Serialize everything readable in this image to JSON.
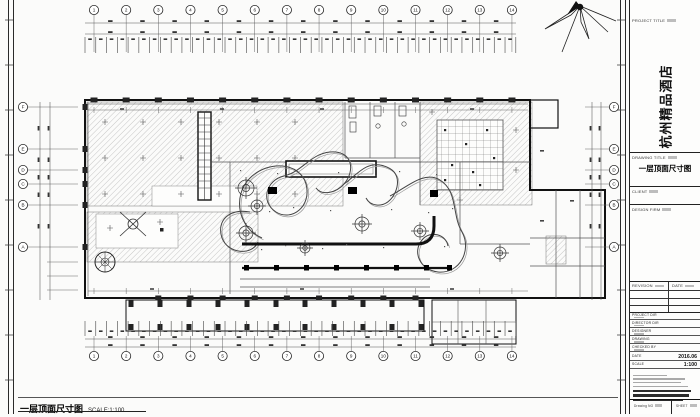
{
  "titleblock": {
    "project_title_label": "PROJECT TITLE",
    "project_name": "杭州精品酒店",
    "drawing_title_label": "DRAWING TITLE",
    "drawing_title": "一层顶面尺寸图",
    "client_label": "CLIENT",
    "design_firm_label": "DESIGN FIRM",
    "revision_label": "REVISION",
    "revision_date_label": "DATE",
    "fields": [
      "PROJECT DIR",
      "DIRECTOR DIR",
      "DESIGNER",
      "DRAWING",
      "CHECKED BY"
    ],
    "date_label": "DATE",
    "date_value": "2016.06",
    "scale_label": "SCALE",
    "scale_value": "1:100",
    "drawing_no_label": "Drawing NO",
    "sheet_label": "SHEET"
  },
  "plan": {
    "columns": [
      "1",
      "2",
      "3",
      "4",
      "5",
      "6",
      "7",
      "8",
      "9",
      "10",
      "11",
      "12",
      "13",
      "14"
    ],
    "rows": [
      "F",
      "E",
      "D",
      "C",
      "B",
      "A"
    ]
  },
  "caption": {
    "title": "一层顶面尺寸图",
    "scale": "SCALE:1:100"
  },
  "colors": {
    "ink": "#1a1a1a",
    "hatch": "#8a8a8a",
    "dim": "#3a3a3a",
    "light": "#6f6f6f"
  }
}
